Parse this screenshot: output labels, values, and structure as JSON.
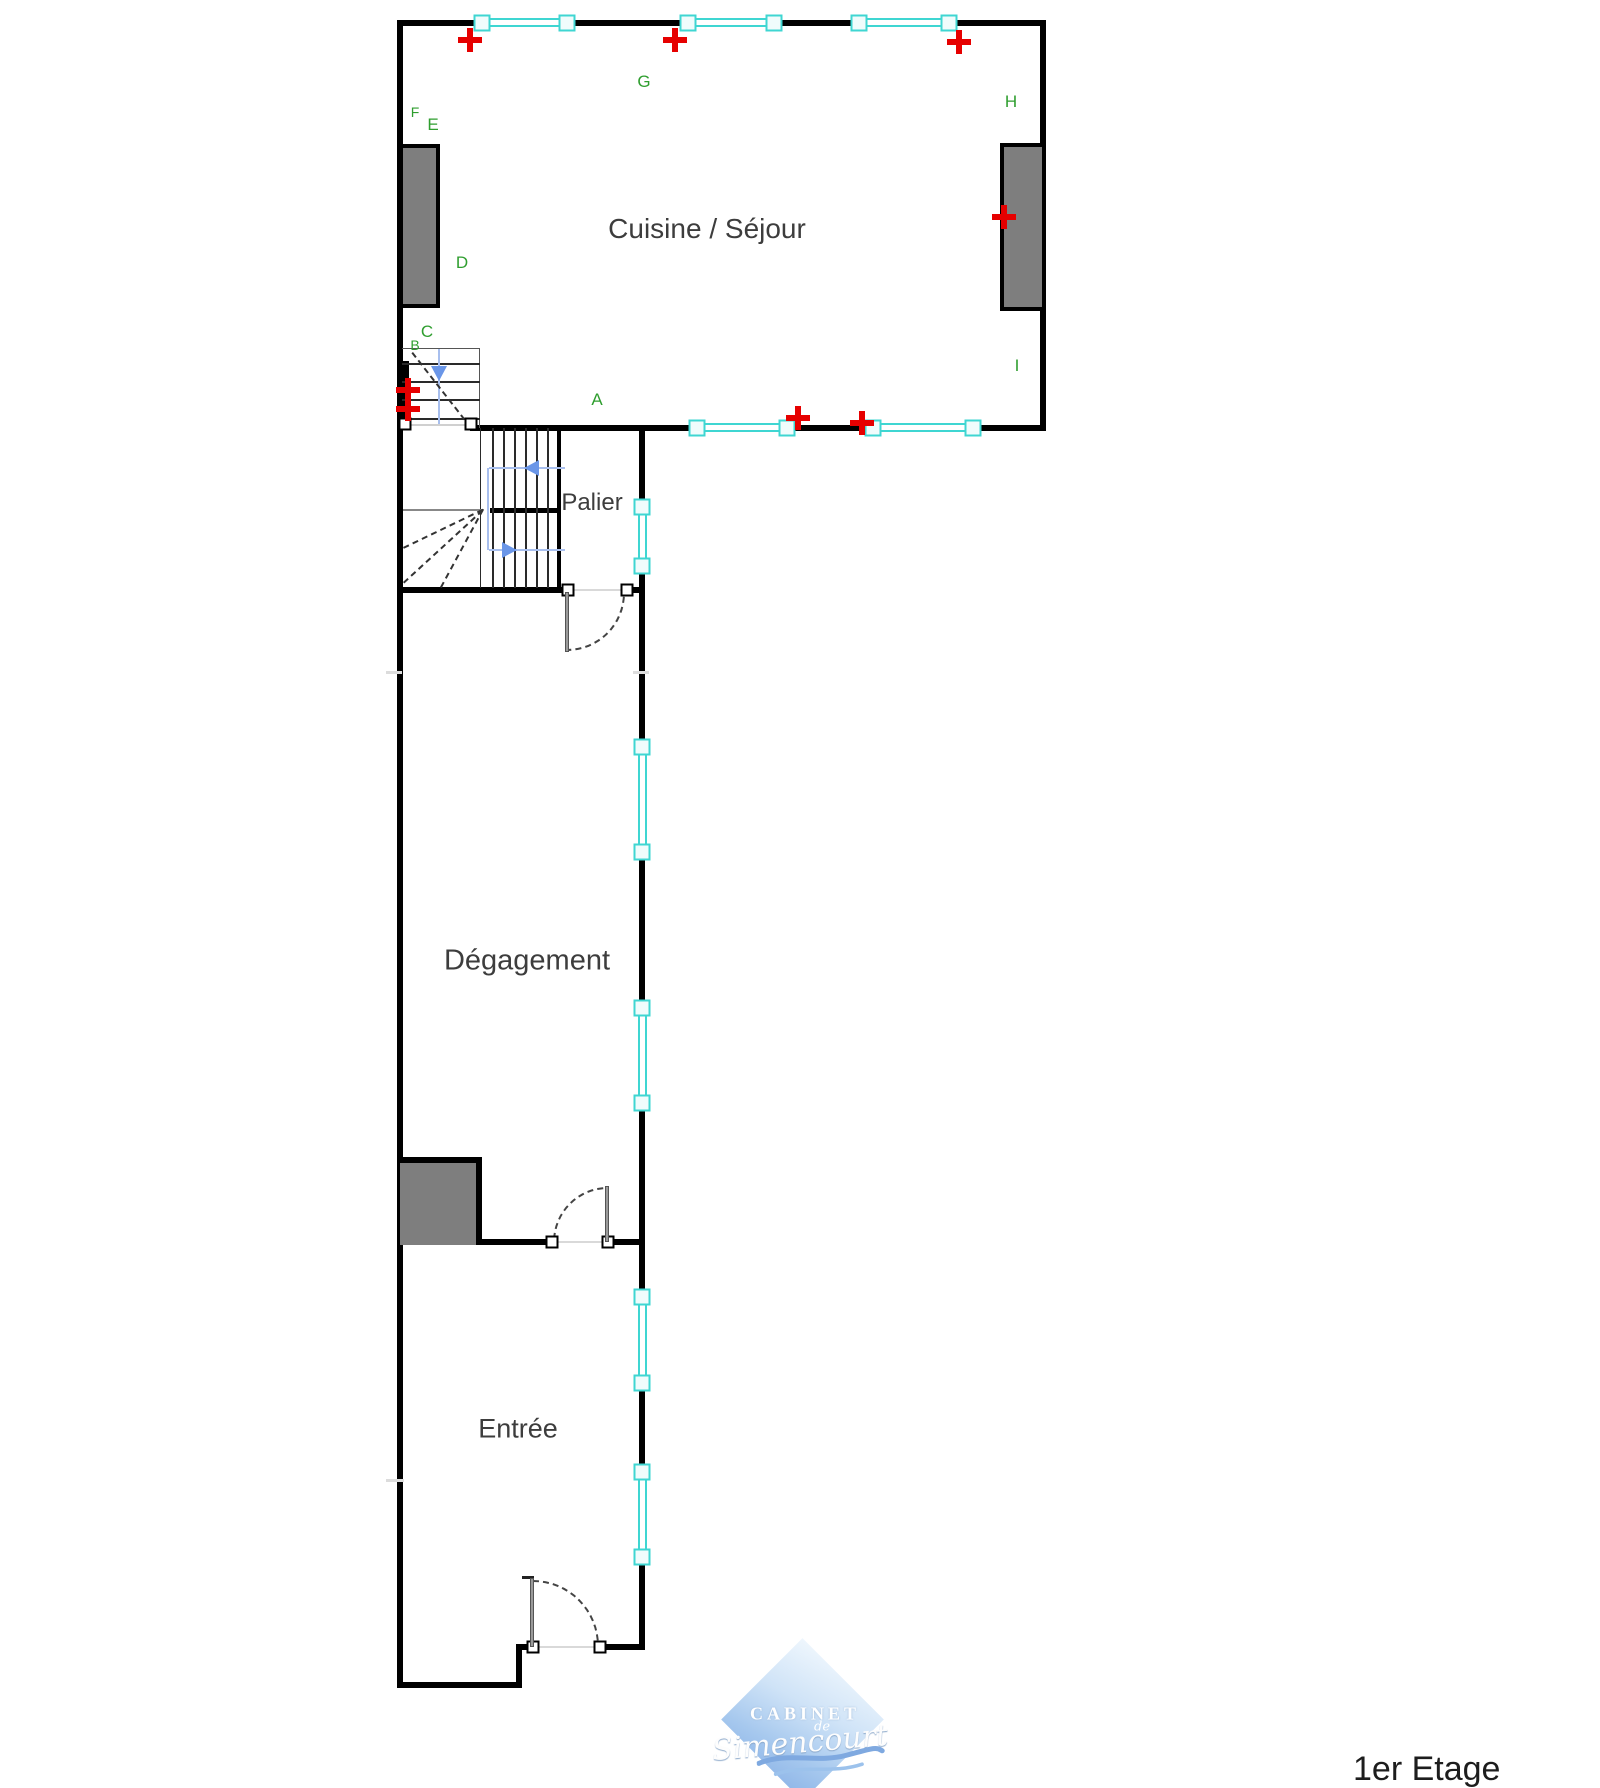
{
  "meta": {
    "floor_label": "1er Etage"
  },
  "rooms": [
    {
      "name": "cuisine-sejour",
      "label": "Cuisine / Séjour"
    },
    {
      "name": "palier",
      "label": "Palier"
    },
    {
      "name": "degagement",
      "label": "Dégagement"
    },
    {
      "name": "entree",
      "label": "Entrée"
    }
  ],
  "reference_letters": [
    {
      "char": "A"
    },
    {
      "char": "B"
    },
    {
      "char": "C"
    },
    {
      "char": "D"
    },
    {
      "char": "E"
    },
    {
      "char": "F"
    },
    {
      "char": "G"
    },
    {
      "char": "H"
    },
    {
      "char": "I"
    }
  ],
  "logo": {
    "line1": "CABINET",
    "line2": "de",
    "line3": "Simencourt"
  },
  "colors": {
    "wall": "#000000",
    "window": "#3fd6d2",
    "marker": "#e60000",
    "letter": "#2f9e2f",
    "arrow": "#6a96e8",
    "arrow_light": "#a8bfee",
    "fill_gray": "#7e7e7e",
    "ink": "#3d3d3d",
    "logo_blue": "#a9c9ee"
  }
}
